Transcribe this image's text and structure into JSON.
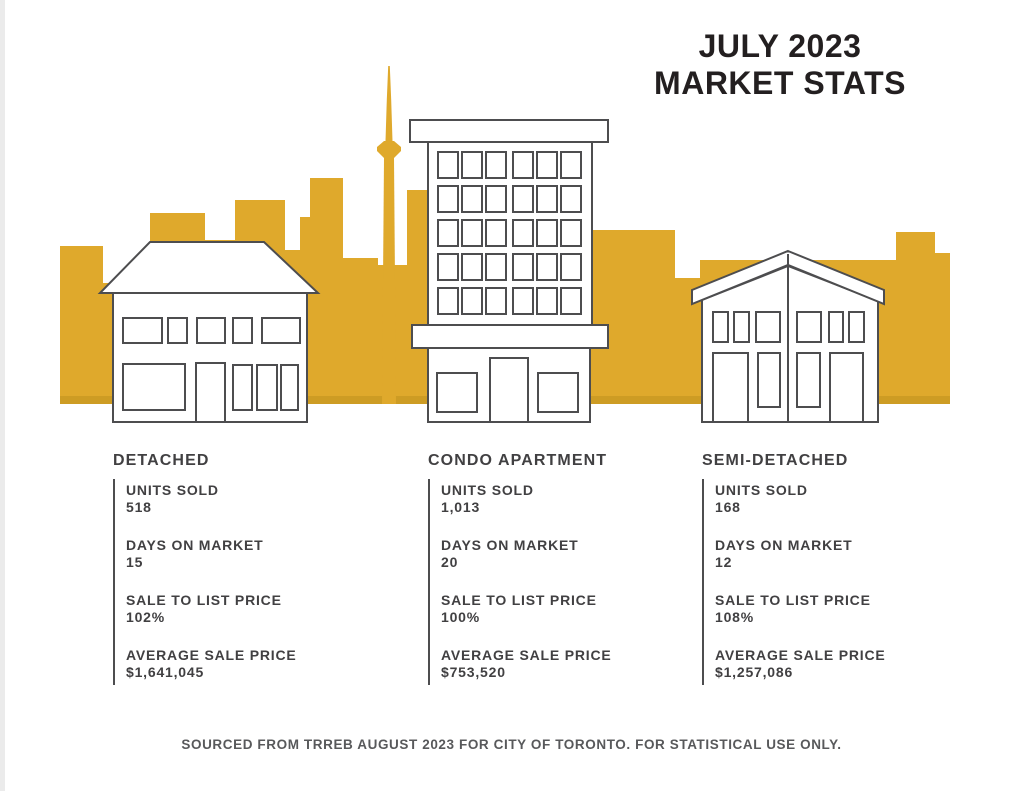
{
  "page": {
    "title_line1": "JULY 2023",
    "title_line2": "MARKET STATS",
    "footer": "SOURCED FROM TRREB AUGUST 2023 FOR CITY OF TORONTO. FOR STATISTICAL USE ONLY."
  },
  "colors": {
    "gold": "#DFA92C",
    "gold_dark": "#CD9C24",
    "outline": "#4D4D4F",
    "title_text": "#231F20",
    "stat_text": "#414042",
    "footer_text": "#58595B"
  },
  "illustration": {
    "skyline_icon": "toronto-skyline-silhouette",
    "tower_icon": "cn-tower",
    "buildings": [
      "detached-house",
      "condo-apartment-building",
      "semi-detached-house"
    ]
  },
  "stats": {
    "columns": [
      {
        "category": "DETACHED",
        "stats": [
          {
            "label": "UNITS SOLD",
            "value": "518"
          },
          {
            "label": "DAYS ON MARKET",
            "value": "15"
          },
          {
            "label": "SALE TO LIST PRICE",
            "value": "102%"
          },
          {
            "label": "AVERAGE SALE PRICE",
            "value": "$1,641,045"
          }
        ]
      },
      {
        "category": "CONDO APARTMENT",
        "stats": [
          {
            "label": "UNITS SOLD",
            "value": "1,013"
          },
          {
            "label": "DAYS ON MARKET",
            "value": "20"
          },
          {
            "label": "SALE TO LIST PRICE",
            "value": "100%"
          },
          {
            "label": "AVERAGE SALE PRICE",
            "value": "$753,520"
          }
        ]
      },
      {
        "category": "SEMI-DETACHED",
        "stats": [
          {
            "label": "UNITS SOLD",
            "value": "168"
          },
          {
            "label": "DAYS ON MARKET",
            "value": "12"
          },
          {
            "label": "SALE TO LIST PRICE",
            "value": "108%"
          },
          {
            "label": "AVERAGE SALE PRICE",
            "value": "$1,257,086"
          }
        ]
      }
    ]
  }
}
